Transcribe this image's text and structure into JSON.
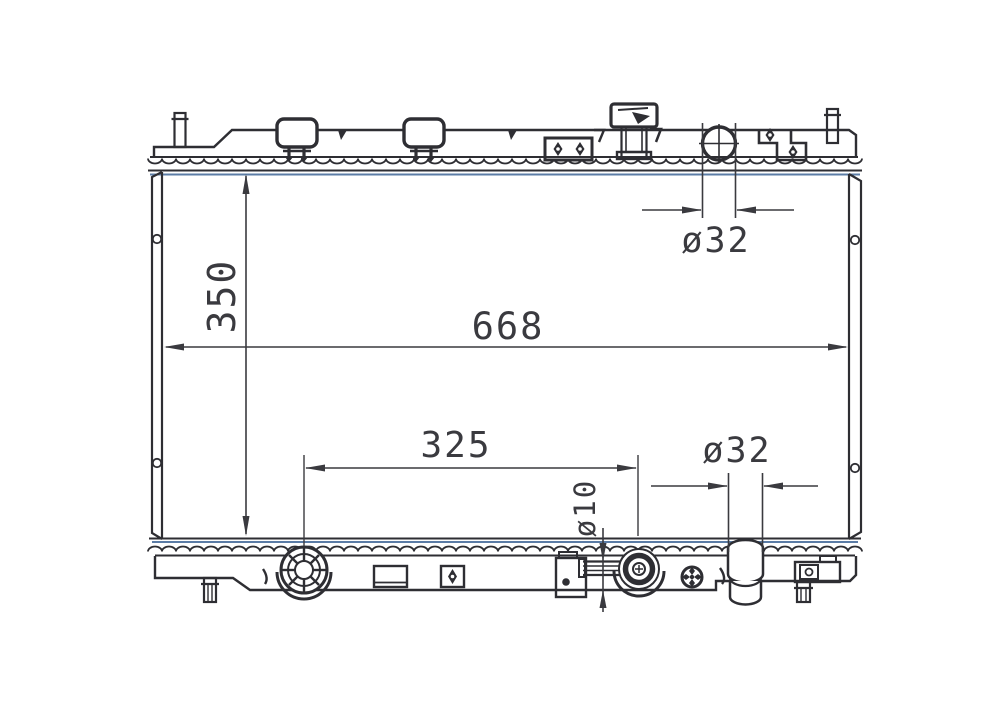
{
  "drawing": {
    "labels": {
      "core_height": "350",
      "overall_width": "668",
      "drain_to_oilcooler": "325",
      "inlet_diameter": "ø32",
      "outlet_diameter": "ø32",
      "oilcooler_pipe_diameter": "ø10"
    },
    "colors": {
      "line_ink": "#2e2e33",
      "dimension_ink": "#3a3a3f",
      "header_tint_blue": "#5b7ca6",
      "background": "#ffffff"
    }
  }
}
